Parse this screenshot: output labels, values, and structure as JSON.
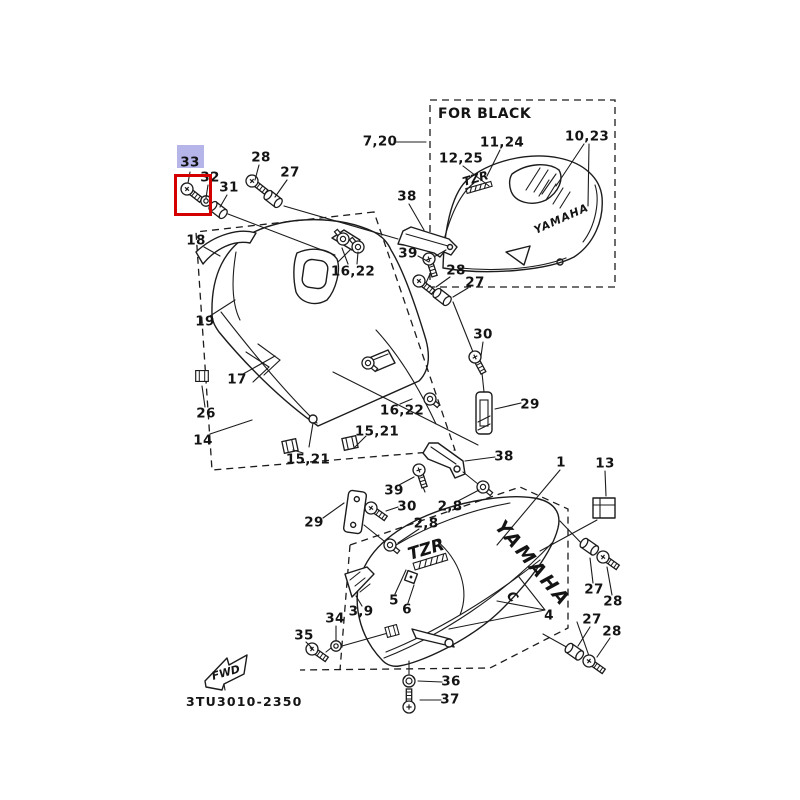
{
  "diagram": {
    "code": "3TU3010-2350",
    "for_black_label": "FOR BLACK",
    "fwd_label": "FWD",
    "brand_text": "YAMAHA",
    "model_text": "TZR",
    "decal_letter": "C"
  },
  "selection": {
    "selected_part": "33",
    "fill_color": "#b5b5ea",
    "border_color": "#d40000"
  },
  "labels": [
    {
      "text": "33",
      "x": 190,
      "y": 163,
      "highlighted": true
    },
    {
      "text": "32",
      "x": 210,
      "y": 178
    },
    {
      "text": "31",
      "x": 229,
      "y": 188
    },
    {
      "text": "28",
      "x": 261,
      "y": 158
    },
    {
      "text": "27",
      "x": 290,
      "y": 173
    },
    {
      "text": "18",
      "x": 196,
      "y": 241
    },
    {
      "text": "19",
      "x": 205,
      "y": 322
    },
    {
      "text": "17",
      "x": 237,
      "y": 380
    },
    {
      "text": "26",
      "x": 206,
      "y": 414
    },
    {
      "text": "14",
      "x": 203,
      "y": 441
    },
    {
      "text": "16,22",
      "x": 353,
      "y": 272
    },
    {
      "text": "16,22",
      "x": 402,
      "y": 411
    },
    {
      "text": "15,21",
      "x": 377,
      "y": 432
    },
    {
      "text": "15,21",
      "x": 308,
      "y": 460
    },
    {
      "text": "7,20",
      "x": 380,
      "y": 142
    },
    {
      "text": "38",
      "x": 407,
      "y": 197
    },
    {
      "text": "39",
      "x": 408,
      "y": 254
    },
    {
      "text": "28",
      "x": 456,
      "y": 271
    },
    {
      "text": "27",
      "x": 475,
      "y": 283
    },
    {
      "text": "11,24",
      "x": 502,
      "y": 143
    },
    {
      "text": "12,25",
      "x": 461,
      "y": 159
    },
    {
      "text": "10,23",
      "x": 587,
      "y": 137
    },
    {
      "text": "30",
      "x": 483,
      "y": 335
    },
    {
      "text": "29",
      "x": 530,
      "y": 405
    },
    {
      "text": "38",
      "x": 504,
      "y": 457
    },
    {
      "text": "39",
      "x": 394,
      "y": 491
    },
    {
      "text": "30",
      "x": 407,
      "y": 507
    },
    {
      "text": "2,8",
      "x": 450,
      "y": 507
    },
    {
      "text": "2,8",
      "x": 426,
      "y": 524
    },
    {
      "text": "29",
      "x": 314,
      "y": 523
    },
    {
      "text": "3,9",
      "x": 361,
      "y": 612
    },
    {
      "text": "34",
      "x": 335,
      "y": 619
    },
    {
      "text": "35",
      "x": 304,
      "y": 636
    },
    {
      "text": "5",
      "x": 394,
      "y": 601
    },
    {
      "text": "6",
      "x": 407,
      "y": 610
    },
    {
      "text": "4",
      "x": 549,
      "y": 616
    },
    {
      "text": "36",
      "x": 451,
      "y": 682
    },
    {
      "text": "37",
      "x": 450,
      "y": 700
    },
    {
      "text": "1",
      "x": 561,
      "y": 463
    },
    {
      "text": "13",
      "x": 605,
      "y": 464
    },
    {
      "text": "27",
      "x": 594,
      "y": 590
    },
    {
      "text": "28",
      "x": 613,
      "y": 602
    },
    {
      "text": "27",
      "x": 592,
      "y": 620
    },
    {
      "text": "28",
      "x": 612,
      "y": 632
    }
  ]
}
